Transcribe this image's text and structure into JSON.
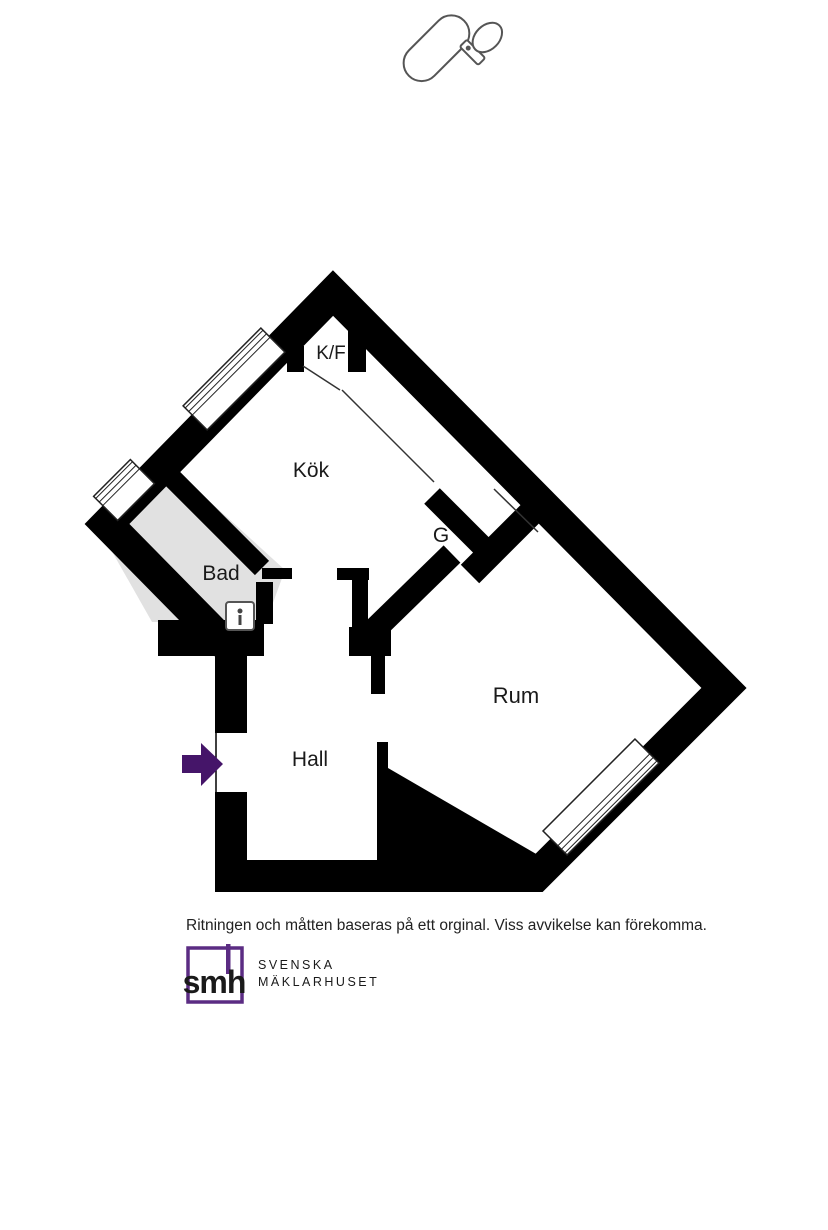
{
  "plan": {
    "rooms": [
      {
        "label": "K/F"
      },
      {
        "label": "Kök"
      },
      {
        "label": "G"
      },
      {
        "label": "Bad"
      },
      {
        "label": "Rum"
      },
      {
        "label": "Hall"
      }
    ],
    "fixtures": [
      "bathtub",
      "toilet",
      "hand-basin",
      "kitchen-sink",
      "stove",
      "ventilation-shaft"
    ],
    "windows": [
      "kitchen-window",
      "bathroom-window",
      "room-window"
    ],
    "entrance": "entrance-arrow"
  },
  "footer": {
    "disclaimer": "Ritningen och måtten baseras på ett orginal. Viss avvikelse kan förekomma."
  },
  "brand": {
    "abbr": "smh",
    "name_line1": "SVENSKA",
    "name_line2": "MÄKLARHUSET"
  },
  "colors": {
    "wall": "#000000",
    "bath_floor": "#e1e1e1",
    "stove_gray": "#a0a0a0",
    "arrow_purple": "#451569",
    "brand_purple": "#5b2c83",
    "brand_gray": "#8a8a8a"
  }
}
